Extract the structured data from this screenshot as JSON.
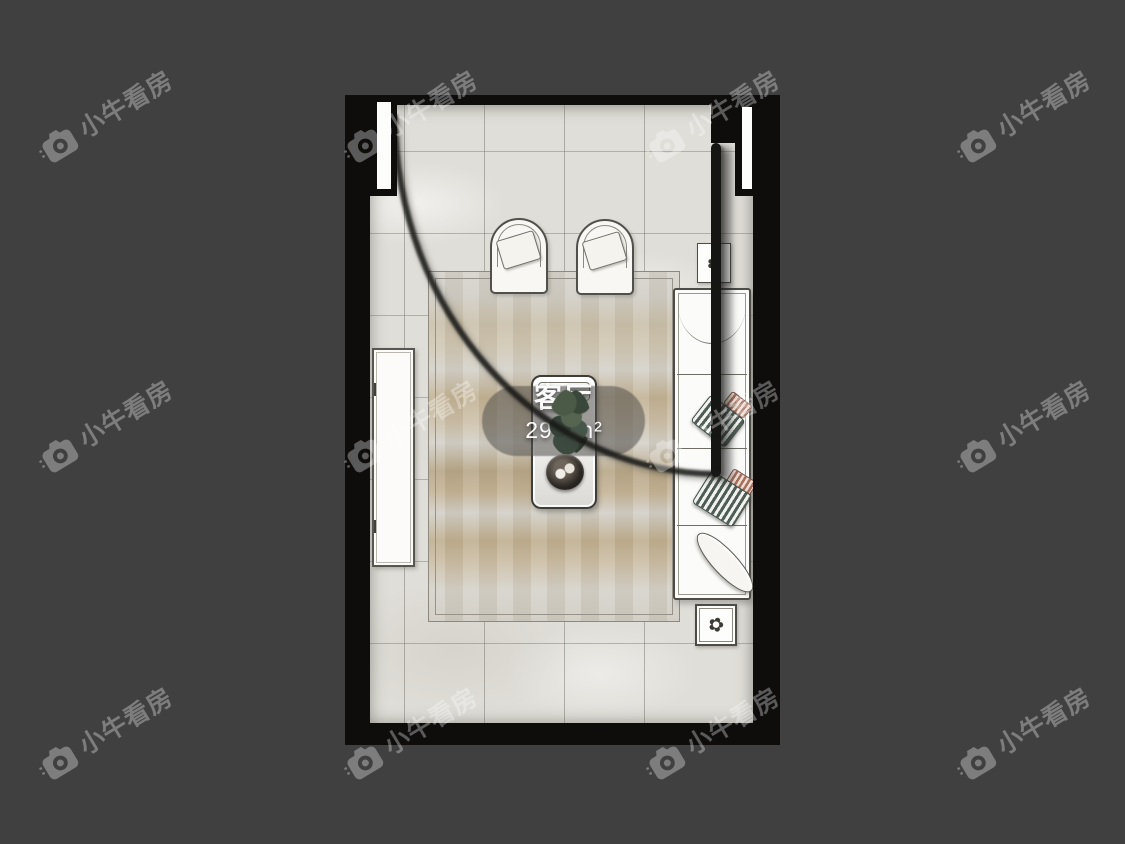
{
  "canvas": {
    "width": 1125,
    "height": 844,
    "background_color": "#404040"
  },
  "watermark": {
    "icon": "camera-icon",
    "text": "小牛看房",
    "color": "rgba(255,255,255,0.32)"
  },
  "floor_plan": {
    "room": {
      "name": "客厅",
      "area": "29.2m²"
    },
    "flower_glyph": "✿",
    "palette": {
      "wall_black": "#0e0d0c",
      "floor_tile": "#e0ded8",
      "tile_grid_line": "#827f77",
      "rug_base": "#d3cfc5",
      "rug_streak": "#b7a687",
      "furniture_fill": "#fbfaf8",
      "furniture_outline": "#4d4c47",
      "pillow_stripe_teal": "#4e5d55",
      "pillow_stripe_copper": "#a56f5c",
      "label_pill": "rgba(82,80,76,0.55)",
      "label_text": "#fafafa"
    },
    "elements": [
      "entry-opening-with-door-swing",
      "door-leaf",
      "door-jamb-cap-top-left",
      "window-cap-top-right",
      "armchair",
      "armchair",
      "area-rug",
      "tv-cabinet",
      "coffee-table",
      "potted-plant",
      "serving-tray",
      "sofa",
      "striped-throw-pillow",
      "striped-throw-pillow",
      "chaise-cushion",
      "flower-side-table-top",
      "flower-side-table-bottom"
    ]
  }
}
